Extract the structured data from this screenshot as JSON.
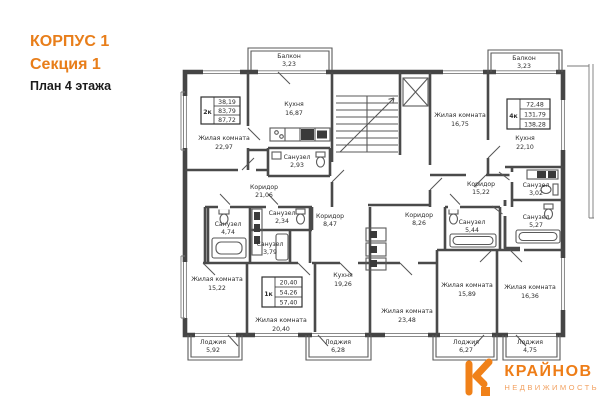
{
  "header": {
    "building": "КОРПУС 1",
    "section": "Секция 1",
    "floor_plan": "План 4 этажа"
  },
  "apartment_boxes": [
    {
      "type": "2к",
      "rows": [
        "38,19",
        "83,79",
        "87,72"
      ]
    },
    {
      "type": "4к",
      "rows": [
        "72,48",
        "131,79",
        "138,28"
      ]
    },
    {
      "type": "1к",
      "rows": [
        "20,40",
        "54,26",
        "57,40"
      ]
    }
  ],
  "rooms": {
    "balcony_left": {
      "name": "Балкон",
      "area": "3,23"
    },
    "balcony_right": {
      "name": "Балкон",
      "area": "3,23"
    },
    "kitchen_16_87": {
      "name": "Кухня",
      "area": "16,87"
    },
    "living_22_97": {
      "name": "Жилая комната",
      "area": "22,97"
    },
    "san_2_93": {
      "name": "Санузел",
      "area": "2,93"
    },
    "corridor_21_06": {
      "name": "Коридор",
      "area": "21,06"
    },
    "san_2_34": {
      "name": "Санузел",
      "area": "2,34"
    },
    "san_4_74": {
      "name": "Санузел",
      "area": "4,74"
    },
    "san_3_79": {
      "name": "Санузел",
      "area": "3,79"
    },
    "corridor_8_47": {
      "name": "Коридор",
      "area": "8,47"
    },
    "corridor_8_26": {
      "name": "Коридор",
      "area": "8,26"
    },
    "living_15_22": {
      "name": "Жилая комната",
      "area": "15,22"
    },
    "living_20_40": {
      "name": "Жилая комната",
      "area": "20,40"
    },
    "kitchen_19_26": {
      "name": "Кухня",
      "area": "19,26"
    },
    "living_23_48": {
      "name": "Жилая комната",
      "area": "23,48"
    },
    "living_15_89": {
      "name": "Жилая комната",
      "area": "15,89"
    },
    "living_16_36": {
      "name": "Жилая комната",
      "area": "16,36"
    },
    "living_16_75": {
      "name": "Жилая комната",
      "area": "16,75"
    },
    "kitchen_22_10": {
      "name": "Кухня",
      "area": "22,10"
    },
    "corridor_15_22": {
      "name": "Коридор",
      "area": "15,22"
    },
    "san_5_44": {
      "name": "Санузел",
      "area": "5,44"
    },
    "san_3_02": {
      "name": "Санузел",
      "area": "3,02"
    },
    "san_5_27": {
      "name": "Санузел",
      "area": "5,27"
    },
    "loggia_5_92": {
      "name": "Лоджия",
      "area": "5,92"
    },
    "loggia_6_28": {
      "name": "Лоджия",
      "area": "6,28"
    },
    "loggia_6_27": {
      "name": "Лоджия",
      "area": "6,27"
    },
    "loggia_4_75": {
      "name": "Лоджия",
      "area": "4,75"
    }
  },
  "logo": {
    "title": "КРАЙНОВ",
    "subtitle": "НЕДВИЖИМОСТЬ"
  }
}
